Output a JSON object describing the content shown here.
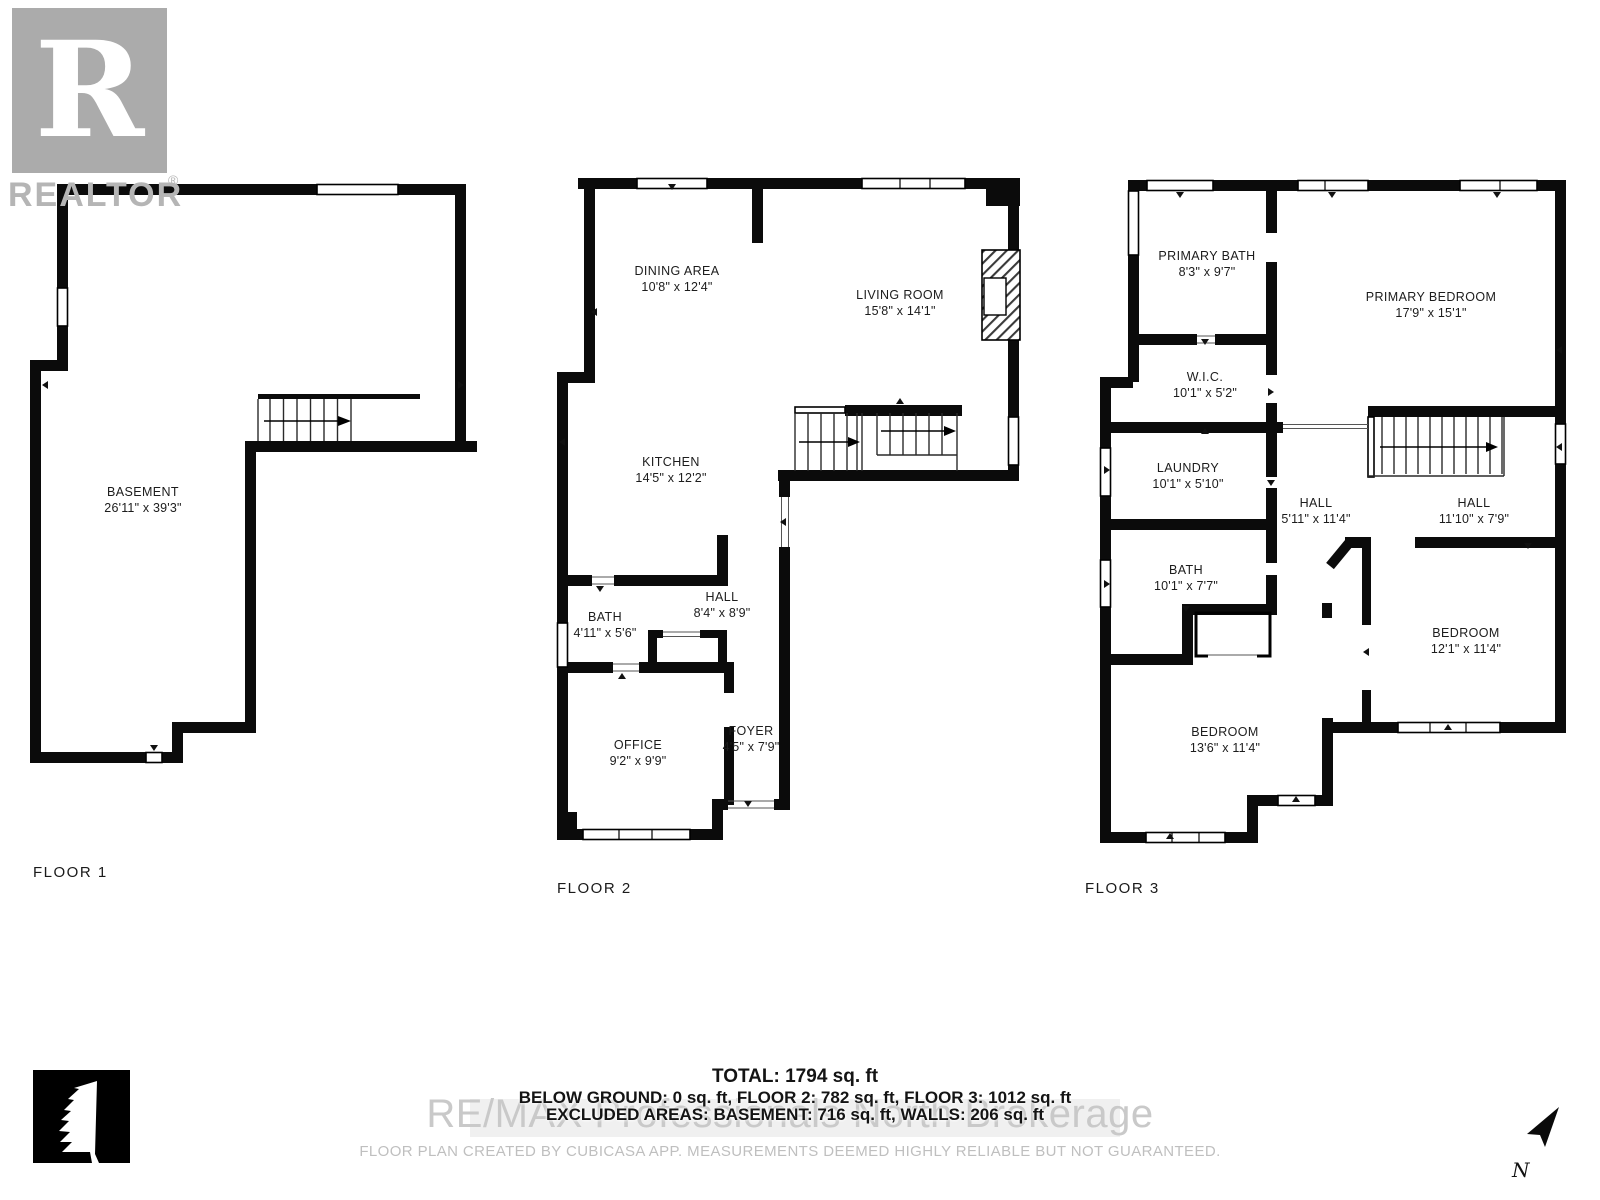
{
  "branding": {
    "realtor_logo_letter": "R",
    "realtor_wordmark": "REALTOR",
    "registered_symbol": "®"
  },
  "floors": [
    {
      "label": "FLOOR 1",
      "rooms": [
        {
          "name": "BASEMENT",
          "dims": "26'11\" x 39'3\""
        }
      ]
    },
    {
      "label": "FLOOR 2",
      "rooms": [
        {
          "name": "DINING AREA",
          "dims": "10'8\" x 12'4\""
        },
        {
          "name": "LIVING ROOM",
          "dims": "15'8\" x 14'1\""
        },
        {
          "name": "KITCHEN",
          "dims": "14'5\" x 12'2\""
        },
        {
          "name": "BATH",
          "dims": "4'11\" x 5'6\""
        },
        {
          "name": "HALL",
          "dims": "8'4\" x 8'9\""
        },
        {
          "name": "OFFICE",
          "dims": "9'2\" x 9'9\""
        },
        {
          "name": "FOYER",
          "dims": "4'5\" x 7'9\""
        }
      ]
    },
    {
      "label": "FLOOR 3",
      "rooms": [
        {
          "name": "PRIMARY BATH",
          "dims": "8'3\" x 9'7\""
        },
        {
          "name": "PRIMARY BEDROOM",
          "dims": "17'9\" x 15'1\""
        },
        {
          "name": "W.I.C.",
          "dims": "10'1\" x 5'2\""
        },
        {
          "name": "LAUNDRY",
          "dims": "10'1\" x 5'10\""
        },
        {
          "name": "HALL",
          "dims": "5'11\" x 11'4\""
        },
        {
          "name": "HALL",
          "dims": "11'10\" x 7'9\""
        },
        {
          "name": "BATH",
          "dims": "10'1\" x 7'7\""
        },
        {
          "name": "BEDROOM",
          "dims": "13'6\" x 11'4\""
        },
        {
          "name": "BEDROOM",
          "dims": "12'1\" x 11'4\""
        }
      ]
    }
  ],
  "footer": {
    "total": "TOTAL: 1794 sq. ft",
    "by_floor": "BELOW GROUND: 0 sq. ft, FLOOR 2: 782 sq. ft, FLOOR 3: 1012 sq. ft",
    "excluded": "EXCLUDED AREAS: BASEMENT: 716 sq. ft, WALLS: 206 sq. ft",
    "watermark": "RE/MAX Professionals North Brokerage",
    "disclaimer": "FLOOR PLAN CREATED BY CUBICASA APP. MEASUREMENTS DEEMED HIGHLY RELIABLE BUT NOT GUARANTEED."
  },
  "compass": {
    "north_label": "N"
  }
}
